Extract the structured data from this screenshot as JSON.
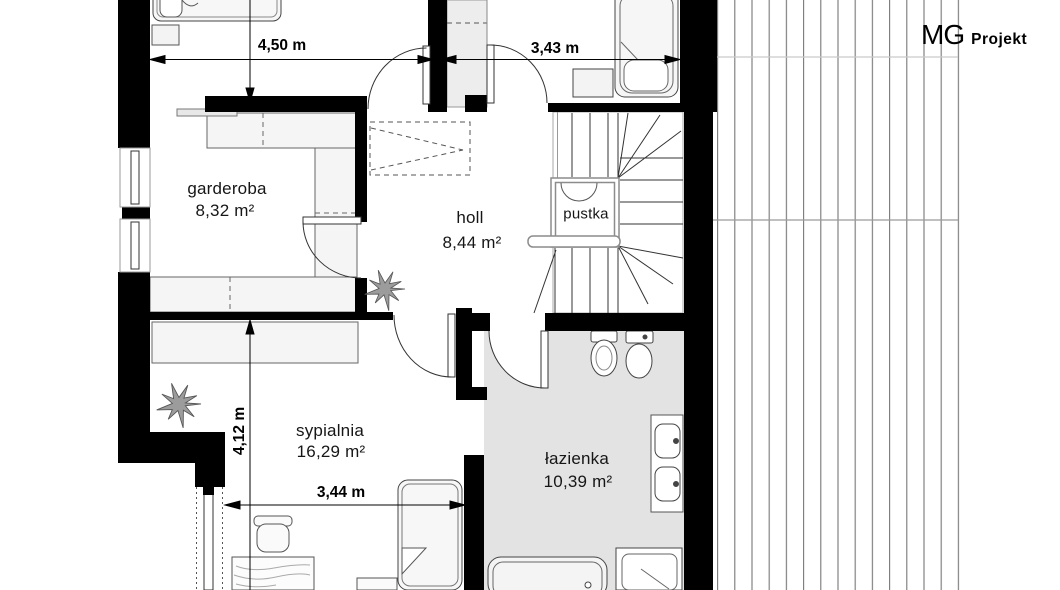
{
  "brand": {
    "mg": "MG",
    "projekt": "Projekt"
  },
  "plan": {
    "rooms": {
      "garderoba": {
        "name": "garderoba",
        "area": "8,32 m²"
      },
      "holl": {
        "name": "holl",
        "area": "8,44 m²"
      },
      "pustka": {
        "name": "pustka"
      },
      "sypialnia": {
        "name": "sypialnia",
        "area": "16,29 m²"
      },
      "lazienka": {
        "name": "łazienka",
        "area": "10,39 m²"
      }
    },
    "dimensions": {
      "top_left": "4,50 m",
      "top_right": "3,43 m",
      "left_vertical": "4,12 m",
      "bottom": "3,44 m"
    },
    "colors": {
      "wall": "#000000",
      "bath_floor": "#e3e3e3",
      "line": "#333333",
      "roof_hatch": "#777777"
    }
  }
}
